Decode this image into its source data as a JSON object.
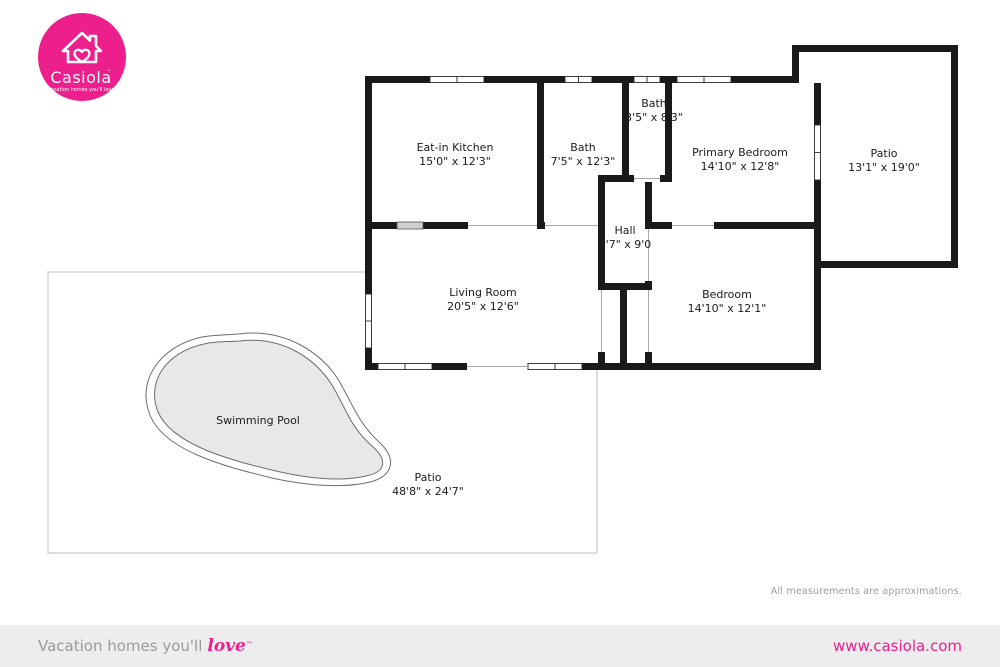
{
  "brand": {
    "logo_name": "Casiola",
    "logo_mark": "™",
    "logo_tagline": "Vacation homes you'll love",
    "accent_color": "#ec1f8d"
  },
  "floorplan": {
    "rooms": {
      "kitchen": {
        "name": "Eat-in Kitchen",
        "dims": "15'0\" x 12'3\""
      },
      "bath1": {
        "name": "Bath",
        "dims": "7'5\" x 12'3\""
      },
      "bath2": {
        "name": "Bath",
        "dims": "3'5\" x 8'3\""
      },
      "primary": {
        "name": "Primary Bedroom",
        "dims": "14'10\" x 12'8\""
      },
      "patio1": {
        "name": "Patio",
        "dims": "13'1\" x 19'0\""
      },
      "hall": {
        "name": "Hall",
        "dims": "3'7\" x 9'0"
      },
      "living": {
        "name": "Living Room",
        "dims": "20'5\" x 12'6\""
      },
      "bedroom": {
        "name": "Bedroom",
        "dims": "14'10\" x 12'1\""
      },
      "pool": {
        "name": "Swimming Pool"
      },
      "patio2": {
        "name": "Patio",
        "dims": "48'8\" x 24'7\""
      }
    },
    "disclaimer": "All measurements are approximations."
  },
  "footer": {
    "tagline_prefix": "Vacation homes you'll",
    "tagline_love": "love",
    "tagline_mark": "~",
    "website": "www.casiola.com"
  }
}
